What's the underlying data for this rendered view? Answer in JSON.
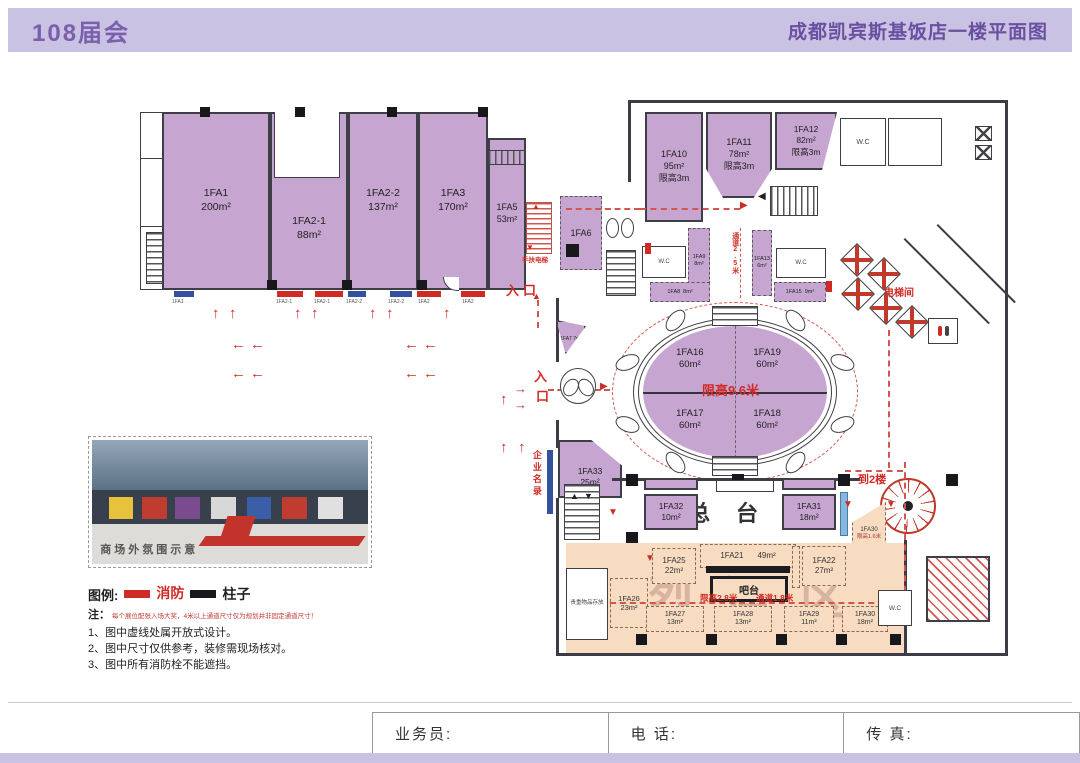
{
  "header": {
    "left": "108届会",
    "right": "成都凯宾斯基饭店一楼平面图"
  },
  "icons": {
    "up": "↑",
    "left": "←",
    "right": "→",
    "tri_up": "▲",
    "tri_down": "▼",
    "tri_left": "◀",
    "tri_right": "▶"
  },
  "labels": {
    "entrance": "入口",
    "ent_in": "入",
    "ent_kou": "口",
    "to2f": "到2楼",
    "elevator_hall": "电梯间",
    "escalator": "手扶电梯",
    "aisle25": "通道2.5米",
    "front_desk": "总台",
    "bar": "吧台",
    "liquor": "烈酒区",
    "valuables": "贵重物品存放",
    "bar_note1": "限高2.8米",
    "bar_note2": "通道1.8米",
    "directory": "企业名录",
    "wc": "W.C",
    "oval_note": "限高9.6米"
  },
  "rooms": {
    "fa1": {
      "name": "1FA1",
      "area": "200m²"
    },
    "fa2_1": {
      "name": "1FA2-1",
      "area": "88m²"
    },
    "fa2_2": {
      "name": "1FA2-2",
      "area": "137m²"
    },
    "fa3": {
      "name": "1FA3",
      "area": "170m²"
    },
    "fa5": {
      "name": "1FA5",
      "area": "53m²"
    },
    "fa6": {
      "name": "1FA6"
    },
    "fa7": {
      "name": "1FA7 7m²"
    },
    "fa8": {
      "name": "1FA8",
      "area": "8m²"
    },
    "fa9": {
      "name": "1FA9",
      "area": "8m²"
    },
    "fa10": {
      "name": "1FA10",
      "area": "95m²",
      "note": "限高3m"
    },
    "fa11": {
      "name": "1FA11",
      "area": "78m²",
      "note": "限高3m"
    },
    "fa12": {
      "name": "1FA12",
      "area": "82m²",
      "note": "限高3m"
    },
    "fa13": {
      "name": "1FA13",
      "area": "6m²"
    },
    "fa15": {
      "name": "1FA15",
      "area": "9m²"
    },
    "fa16": {
      "name": "1FA16",
      "area": "60m²"
    },
    "fa17": {
      "name": "1FA17",
      "area": "60m²"
    },
    "fa18": {
      "name": "1FA18",
      "area": "60m²"
    },
    "fa19": {
      "name": "1FA19",
      "area": "60m²"
    },
    "fa21": {
      "name": "1FA21",
      "area": "49m²"
    },
    "fa22": {
      "name": "1FA22",
      "area": "27m²"
    },
    "fa25": {
      "name": "1FA25",
      "area": "22m²"
    },
    "fa26": {
      "name": "1FA26",
      "area": "23m²"
    },
    "fa27": {
      "name": "1FA27",
      "area": "13m²"
    },
    "fa28": {
      "name": "1FA28",
      "area": "13m²"
    },
    "fa29": {
      "name": "1FA29",
      "area": "11m²"
    },
    "fa30": {
      "name": "1FA30",
      "area": "18m²"
    },
    "fa30_tri": {
      "name": "1FA30",
      "note": "限高1.6米"
    },
    "fa31": {
      "name": "1FA31",
      "area": "18m²"
    },
    "fa32": {
      "name": "1FA32",
      "area": "10m²"
    },
    "fa33": {
      "name": "1FA33",
      "area": "25m²"
    }
  },
  "unit_markers": [
    "1FA1",
    "1FA2-1",
    "1FA2-1",
    "1FA2-2",
    "1FA2-2",
    "1FA2",
    "1FA2"
  ],
  "photo": {
    "caption": "商场外氛围示意"
  },
  "legend": {
    "title": "图例:",
    "fire": "消防",
    "pillar": "柱子"
  },
  "notes": {
    "prefix": "注：",
    "red": "每个展位配张入场大奖，4米以上通道尺寸仅为规划并非固定通道尺寸！",
    "n1": "1、图中虚线处属开放式设计。",
    "n2": "2、图中尺寸仅供参考，装修需现场核对。",
    "n3": "3、图中所有消防栓不能遮挡。"
  },
  "footer": {
    "agent": "业务员:",
    "phone": "电 话:",
    "fax": "传 真:"
  }
}
